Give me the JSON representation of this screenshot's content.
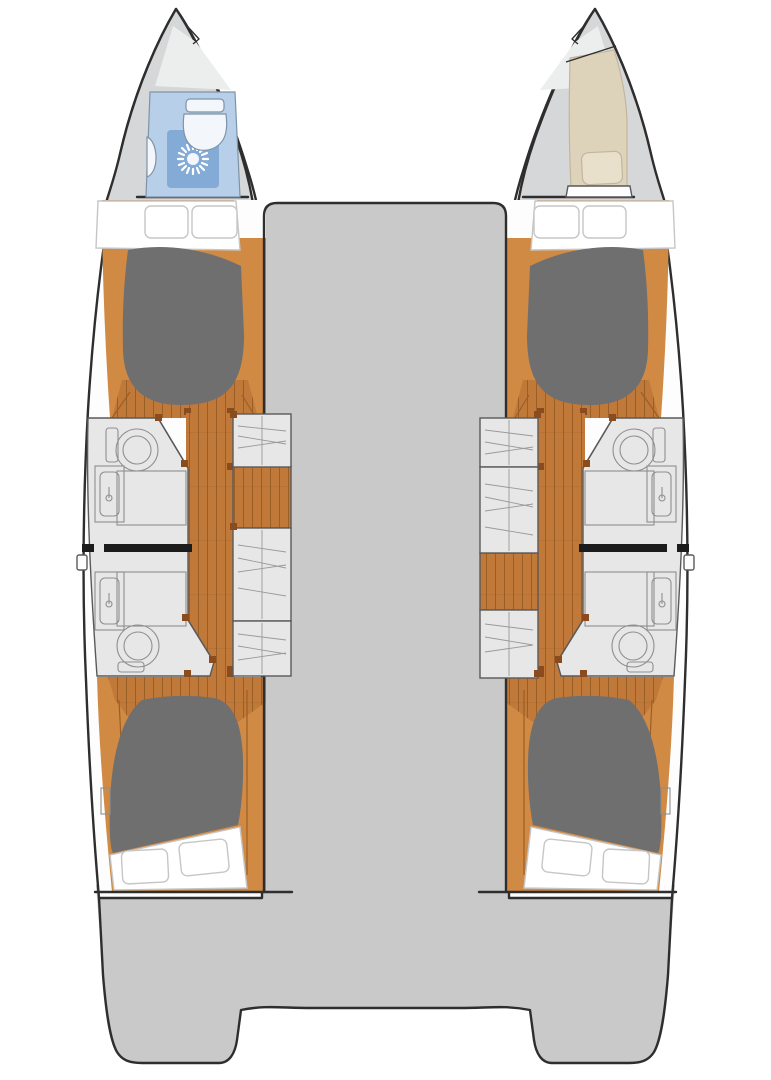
{
  "meta": {
    "title": "Catamaran four-cabin interior floor plan (top view)",
    "canvas": {
      "width": 771,
      "height": 1080
    }
  },
  "colors": {
    "background": "#ffffff",
    "outline": "#2e2e2e",
    "bridge_deck": "#c9c9c9",
    "bow_deck": "#d6d7d8",
    "bow_facet": "#eceded",
    "hull_white": "#fdfdfd",
    "wood_floor": "#c1793a",
    "wood_plank_line": "#9a5f26",
    "wood_wall": "#d08a44",
    "bed_gray": "#6f6f70",
    "linen_white": "#ffffff",
    "linen_outline": "#c6c6c6",
    "fixture_gray": "#e7e7e7",
    "fixture_line": "#8f8f8f",
    "partition_gray": "#5a5a5a",
    "shelf_line": "#9a9a9a",
    "bath_blue": "#b7cfe9",
    "shower_mat_blue": "#84abd6",
    "porcelain": "#f3f6fa",
    "bath_fixture_line": "#7f93a8",
    "berth_beige": "#ddd2ba",
    "pillow_beige": "#e9e0cb",
    "beige_outline": "#c2b79c",
    "divider_black": "#1c1c1c",
    "door_post_brown": "#8a4c1e"
  },
  "icons": {
    "shower_drain": "sunburst",
    "toilet": "bowl-with-tank",
    "sink": "basin-with-faucet"
  },
  "legend": {
    "hulls": 2,
    "double_cabins": 4,
    "bathrooms_midship": 4,
    "port_bow": "wet head (toilet + shower)",
    "starboard_bow": "single berth with pillow",
    "center": "bridge deck",
    "stern": "transom platforms with central cutout"
  }
}
